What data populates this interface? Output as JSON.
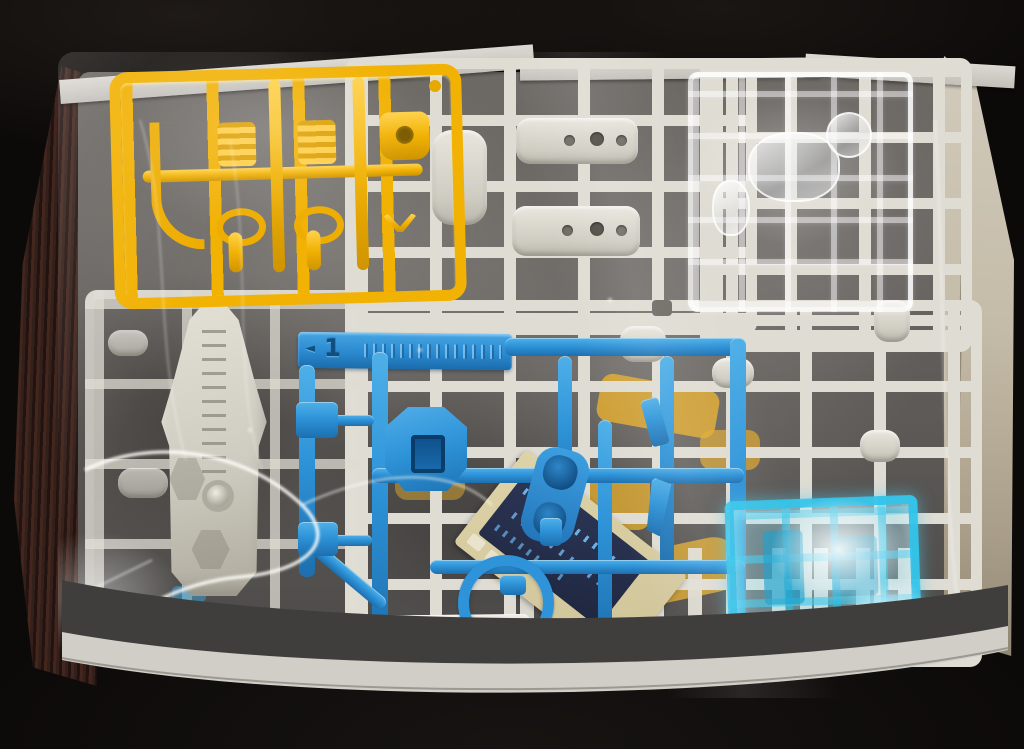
{
  "scene": {
    "type": "photograph",
    "subject": "Opened plastic model kit box showing part runners (sprues) sealed in a clear plastic bag",
    "background": "black fabric"
  },
  "palette": {
    "background": "#0c0a09",
    "box_wall_tan": "#c8beac",
    "box_edge_gray": "#d3d0ca",
    "white_runner": "#e1ded5",
    "yellow_runner": "#f2b204",
    "blue_runner": "#2e93d8",
    "clear_blue_runner": "#3ec6ea",
    "sticker_sheet_tan": "#d8cda6",
    "sticker_navy": "#2a3350",
    "booklet_edge_maroon": "#35231e"
  },
  "runners": [
    {
      "name": "yellow runner",
      "color": "#f2b204"
    },
    {
      "name": "white runner (top center)",
      "color": "#e1ded5"
    },
    {
      "name": "white runner (top right)",
      "color": "#e1ded5"
    },
    {
      "name": "white runner (right/bottom)",
      "color": "#e1ded5"
    },
    {
      "name": "clear runner",
      "color": "transparent"
    },
    {
      "name": "blue runner",
      "color": "#2e93d8"
    },
    {
      "name": "clear blue runner",
      "color": "#3ec6ea"
    }
  ],
  "blue_tab": {
    "arrow": "◄",
    "number": "1"
  },
  "marks": {
    "copyright": "©"
  }
}
